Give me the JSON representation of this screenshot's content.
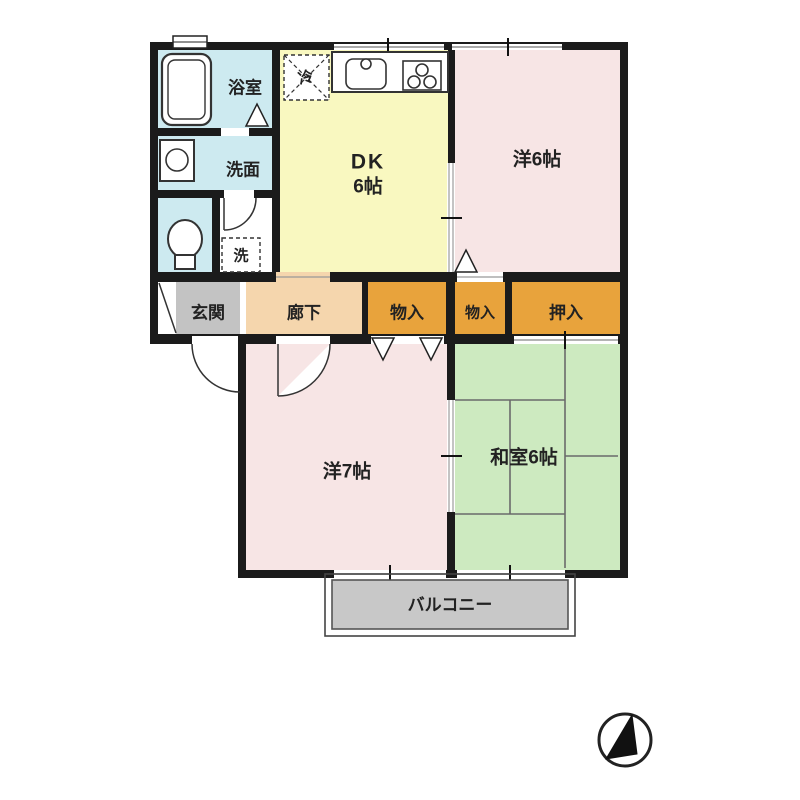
{
  "meta": {
    "type": "japanese-apartment-floor-plan"
  },
  "colors": {
    "wall": "#1b1b1b",
    "water_rooms": "#cdeaf0",
    "dk": "#f9f8c0",
    "western_room": "#f7e5e5",
    "hallway": "#f5d6ad",
    "entrance": "#c3c3c3",
    "closet": "#e8a33c",
    "tatami_room": "#cdeac0",
    "balcony": "#c8c8c8",
    "white": "#ffffff",
    "line": "#333333"
  },
  "rooms": {
    "bathroom": {
      "label": "浴室"
    },
    "washroom": {
      "label": "洗面"
    },
    "dining_kitchen": {
      "label": "DK",
      "size": "6帖"
    },
    "western6": {
      "label": "洋6帖"
    },
    "entrance": {
      "label": "玄関"
    },
    "hallway": {
      "label": "廊下"
    },
    "storage1": {
      "label": "物入"
    },
    "storage2": {
      "label": "物入"
    },
    "oshiire": {
      "label": "押入"
    },
    "western7": {
      "label": "洋7帖"
    },
    "japanese6": {
      "label": "和室6帖"
    },
    "balcony": {
      "label": "バルコニー"
    }
  },
  "fixtures": {
    "refrigerator": {
      "label": "冷"
    },
    "laundry": {
      "label": "洗"
    }
  }
}
